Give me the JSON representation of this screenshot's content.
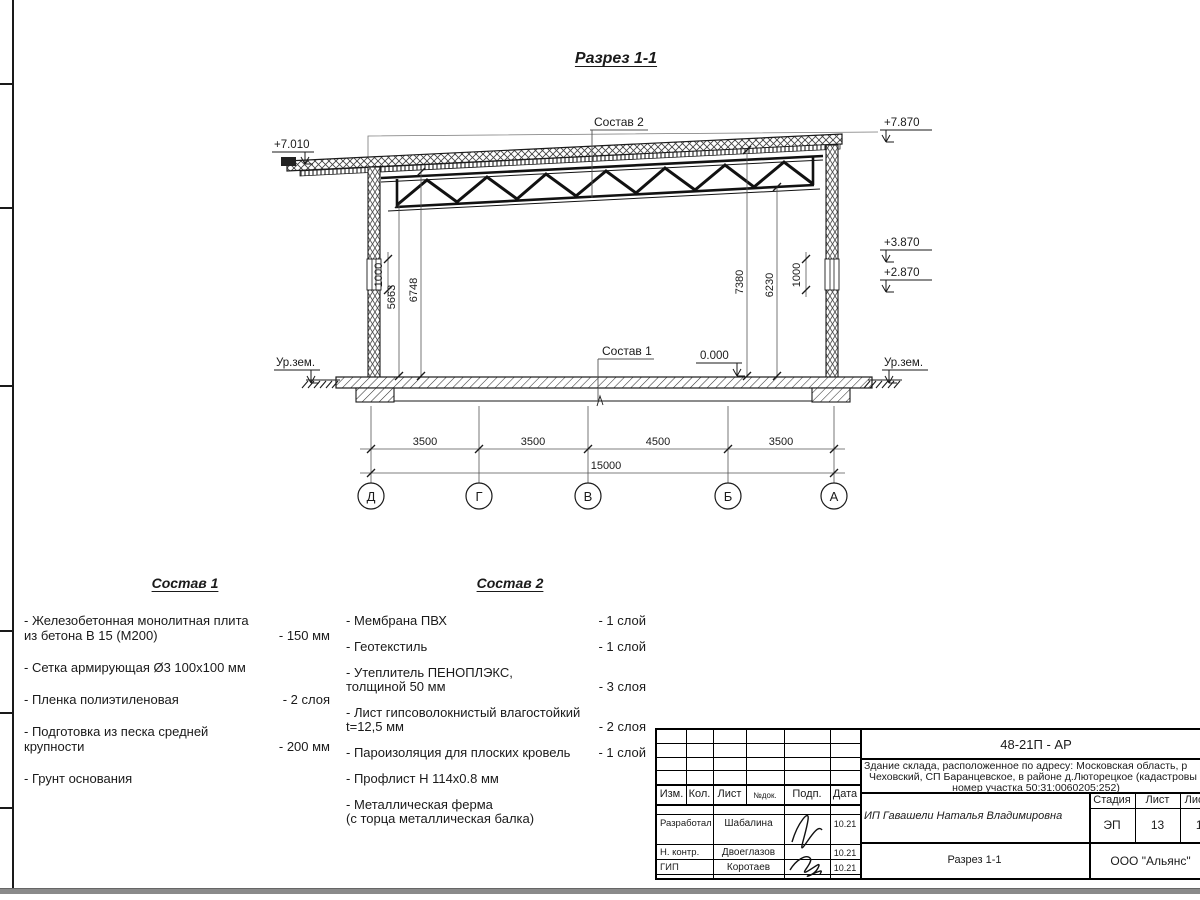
{
  "drawing": {
    "title": "Разрез 1-1",
    "elevations": {
      "left_top": "+7.010",
      "right_top": "+7.870",
      "right_mid_upper": "+3.870",
      "right_mid_lower": "+2.870",
      "floor_zero": "0.000",
      "ground_left": "Ур.зем.",
      "ground_right": "Ур.зем."
    },
    "callouts": {
      "roof": "Состав 2",
      "floor": "Состав 1"
    },
    "vertical_dims": {
      "left_wall_band": "1000",
      "left_inner_1": "5663",
      "left_inner_2": "6748",
      "right_inner_1": "7380",
      "right_inner_2": "6230",
      "right_wall_band": "1000"
    },
    "bottom_dims": {
      "segments": [
        "3500",
        "3500",
        "4500",
        "3500"
      ],
      "total": "15000"
    },
    "axes": [
      "Д",
      "Г",
      "В",
      "Б",
      "А"
    ]
  },
  "sostav1": {
    "title": "Состав 1",
    "items": [
      {
        "name": "- Железобетонная  монолитная плита\nиз бетона В 15 (М200)",
        "value": "- 150 мм"
      },
      {
        "name": "- Сетка армирующая Ø3 100х100 мм",
        "value": ""
      },
      {
        "name": "- Пленка полиэтиленовая",
        "value": "-  2 слоя"
      },
      {
        "name": "- Подготовка из песка средней\nкрупности",
        "value": "- 200 мм"
      },
      {
        "name": "- Грунт основания",
        "value": ""
      }
    ]
  },
  "sostav2": {
    "title": "Состав 2",
    "items": [
      {
        "name": "- Мембрана ПВХ",
        "value": "- 1 слой"
      },
      {
        "name": "- Геотекстиль",
        "value": "- 1 слой"
      },
      {
        "name": "- Утеплитель ПЕНОПЛЭКС,\nтолщиной 50 мм",
        "value": "- 3 слоя"
      },
      {
        "name": "- Лист гипсоволокнистый влагостойкий\nt=12,5 мм",
        "value": "- 2 слоя"
      },
      {
        "name": "- Пароизоляция для плоских кровель",
        "value": "- 1 слой"
      },
      {
        "name": "- Профлист Н 114х0.8 мм",
        "value": ""
      },
      {
        "name": "- Металлическая ферма\n(с торца металлическая балка)",
        "value": ""
      }
    ]
  },
  "title_block": {
    "code": "48-21П - АР",
    "description_lines": [
      "Здание склада, расположенное по адресу: Московская область, р",
      "Чеховский, СП Баранцевское, в районе д.Люторецкое  (кадастровы",
      "номер участка 50:31:0060205:252)"
    ],
    "columns": [
      "Изм.",
      "Кол.",
      "Лист",
      "№док.",
      "Подп.",
      "Дата"
    ],
    "rows": [
      {
        "role": "Разработал",
        "name": "Шабалина",
        "date": "10.21"
      },
      {
        "role": "Н. контр.",
        "name": "Двоеглазов",
        "date": "10.21"
      },
      {
        "role": "ГИП",
        "name": "Коротаев",
        "date": "10.21"
      }
    ],
    "client": "ИП Гавашели Наталья Владимировна",
    "stage_label": "Стадия",
    "sheet_label": "Лист",
    "sheets_label": "Листов",
    "stage": "ЭП",
    "sheet": "13",
    "sheets": "15",
    "doc_title": "Разрез 1-1",
    "company": "ООО \"Альянс\""
  }
}
